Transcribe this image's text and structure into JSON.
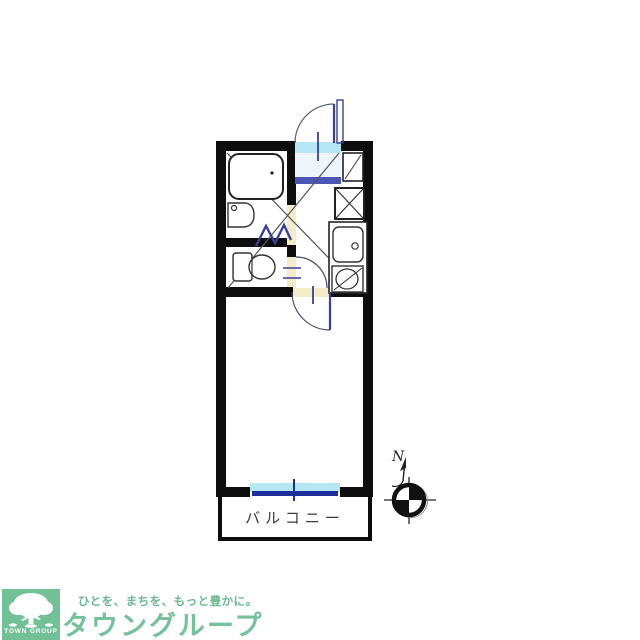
{
  "floorplan": {
    "balcony_label": "バルコニー",
    "compass_label": "N",
    "rooms": [
      "bathroom",
      "toilet",
      "entrance-hall",
      "kitchen",
      "main-room",
      "balcony"
    ],
    "fixtures": [
      "bathtub",
      "wash-basin",
      "toilet-bowl",
      "shoe-cabinet",
      "appliance-space",
      "kitchen-sink",
      "stove-burner"
    ],
    "doors": [
      "entrance-swing-door",
      "bathroom-folding-door",
      "toilet-swing-door",
      "room-swing-door",
      "balcony-sliding-window"
    ]
  },
  "logo": {
    "tagline": "ひとを、まちを、もっと豊かに。",
    "brand": "タウングループ",
    "mark_text": "TOWN GROUP",
    "mark_icon": "tree-icon"
  },
  "colors": {
    "wall": "#0d0d0d",
    "door_blue": "#3a3f9c",
    "window_cyan": "#b5e8f4",
    "window_blue": "#1e2f9b",
    "threshold_cream": "#f3ecc8",
    "genkan_step_blue": "#4a55b5",
    "brand_green": "#72c096",
    "brand_text_green": "#74c29a"
  }
}
